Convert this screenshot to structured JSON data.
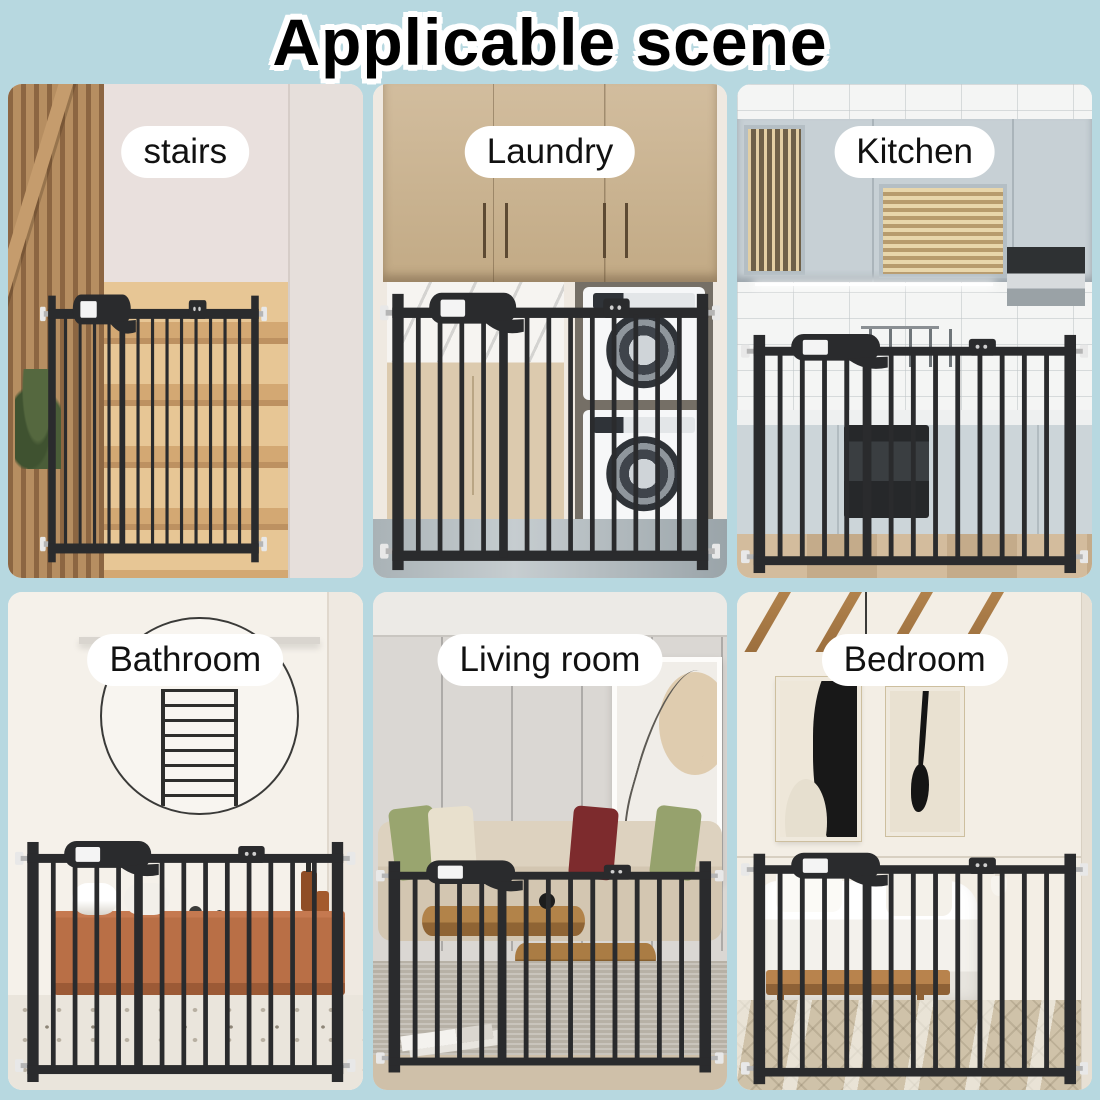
{
  "title": "Applicable scene",
  "colors": {
    "background": "#b7d8e0",
    "label_bg": "#ffffff",
    "label_text": "#111111",
    "gate": "#2a2b2d",
    "title_text": "#000000",
    "title_outline": "#ffffff"
  },
  "panels": [
    {
      "id": "stairs",
      "label": "stairs"
    },
    {
      "id": "laundry",
      "label": "Laundry"
    },
    {
      "id": "kitchen",
      "label": "Kitchen"
    },
    {
      "id": "bathroom",
      "label": "Bathroom"
    },
    {
      "id": "living-room",
      "label": "Living room"
    },
    {
      "id": "bedroom",
      "label": "Bedroom"
    }
  ]
}
